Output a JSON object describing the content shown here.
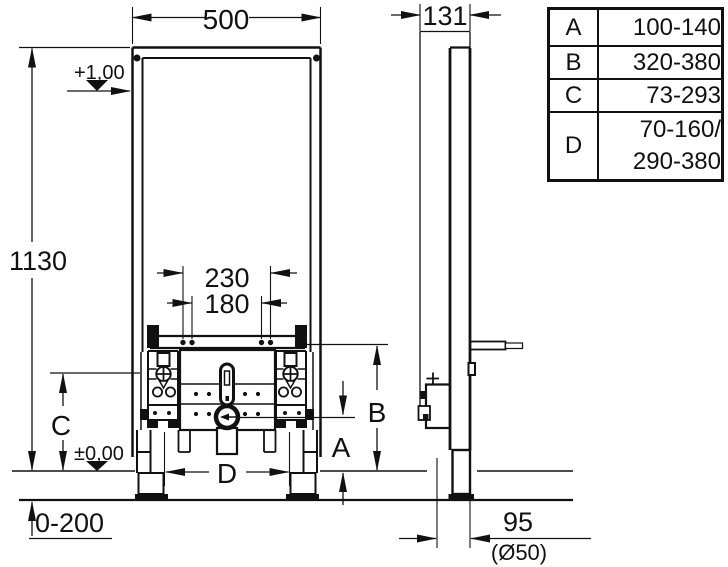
{
  "page": {
    "background": "#ffffff",
    "line_color": "#111111"
  },
  "drawing": {
    "dimensions": {
      "frame_width": "500",
      "frame_depth": "131",
      "frame_height": "1130",
      "anchor_spacing_outer": "230",
      "anchor_spacing_inner": "180",
      "label_a": "A",
      "label_b": "B",
      "label_c": "C",
      "label_d": "D",
      "floor_buildup_range": "0-200",
      "outlet_wall_distance": "95",
      "outlet_pipe_diameter": "(Ø50)",
      "level_top": "+1,00",
      "level_floor": "±0,00"
    },
    "table": {
      "rows": [
        {
          "key": "A",
          "lines": [
            "100-140"
          ]
        },
        {
          "key": "B",
          "lines": [
            "320-380"
          ]
        },
        {
          "key": "C",
          "lines": [
            "73-293"
          ]
        },
        {
          "key": "D",
          "lines": [
            "70-160/",
            "290-380"
          ]
        }
      ]
    }
  }
}
